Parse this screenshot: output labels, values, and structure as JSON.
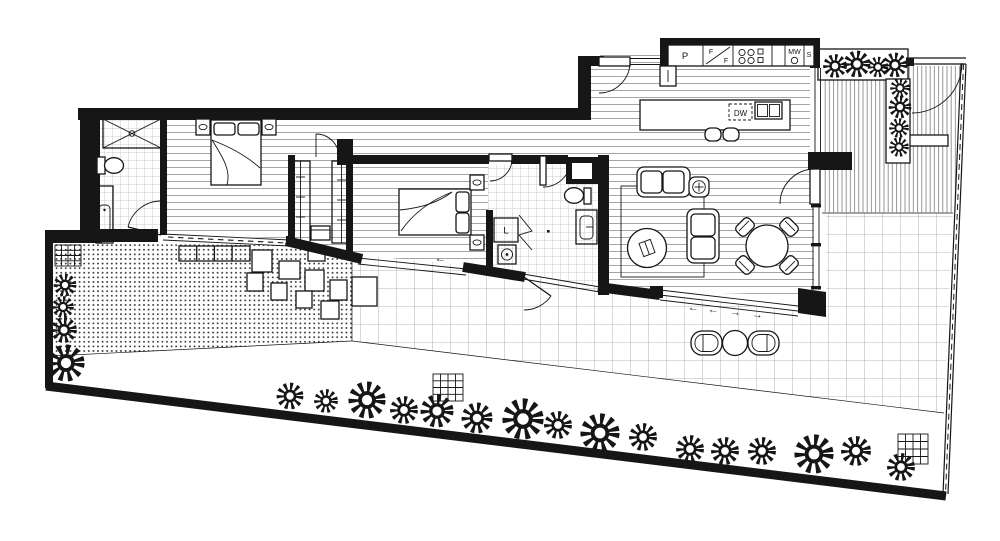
{
  "document": {
    "kind": "architectural-floor-plan",
    "style": "black-and-white apartment plan with landscaped terrace",
    "palette": {
      "ink": "#161616",
      "paper": "#ffffff",
      "wood_line": "#8f8f8f",
      "tile_small": "#bdbdbd",
      "tile_large": "#9f9f9f",
      "deck_line": "#7d7d7d",
      "dot": "#2e2e2e"
    }
  },
  "labels": {
    "pantry": "P",
    "fridge_top": "F",
    "fridge_bottom": "F",
    "microwave": "MW",
    "sink": "S",
    "dishwasher": "DW",
    "laundry": "L"
  },
  "arrows": {
    "left1": "←",
    "left2": "←",
    "right1": "→",
    "right2": "→"
  },
  "symbols": {
    "rooms": [
      "bedroom-1",
      "ensuite",
      "walk-in-robe",
      "bedroom-2",
      "bathroom",
      "laundry",
      "hallway",
      "kitchen",
      "living-room",
      "dining-area"
    ],
    "fixtures": [
      "queen-bed",
      "pillows",
      "nightstand-with-lamp",
      "wardrobe",
      "shower",
      "toilet",
      "vanity-basin",
      "washing-machine",
      "kitchen-bench",
      "cooktop",
      "kitchen-island",
      "double-sink",
      "bar-stools",
      "sofa",
      "coffee-table",
      "side-table",
      "rug",
      "round-dining-table",
      "dining-chair"
    ],
    "outdoor": [
      "lawn-dotted",
      "paved-terrace-tiles",
      "timber-deck",
      "planter-box",
      "shrub-flower",
      "stepping-stones",
      "drain-grate",
      "outdoor-lounge-chair",
      "outdoor-round-table",
      "boundary-fence",
      "gate",
      "sliding-stacker-door"
    ]
  }
}
